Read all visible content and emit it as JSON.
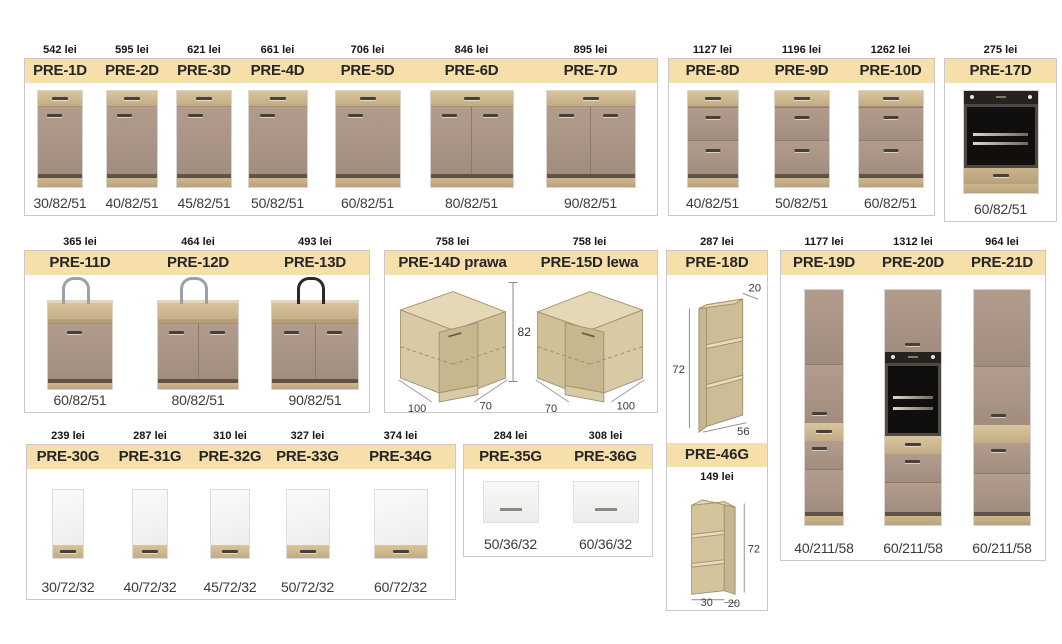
{
  "catalog": {
    "colors": {
      "header_band": "#f6dfaa",
      "box_border": "#c9c9c9",
      "cabinet_door": "#a89384",
      "wood": "#cdb690",
      "dark_strip": "#5f5347",
      "white_door": "#f5f5f3",
      "oven_black": "#141414",
      "page_bg": "#ffffff"
    },
    "groups": [
      {
        "key": "A",
        "name": "base-cabinets-1-7",
        "items": [
          {
            "code": "PRE-1D",
            "price": "542 lei",
            "dims": "30/82/51",
            "art": "base1"
          },
          {
            "code": "PRE-2D",
            "price": "595 lei",
            "dims": "40/82/51",
            "art": "base1"
          },
          {
            "code": "PRE-3D",
            "price": "621 lei",
            "dims": "45/82/51",
            "art": "base1"
          },
          {
            "code": "PRE-4D",
            "price": "661 lei",
            "dims": "50/82/51",
            "art": "base1"
          },
          {
            "code": "PRE-5D",
            "price": "706 lei",
            "dims": "60/82/51",
            "art": "base1"
          },
          {
            "code": "PRE-6D",
            "price": "846 lei",
            "dims": "80/82/51",
            "art": "base2"
          },
          {
            "code": "PRE-7D",
            "price": "895 lei",
            "dims": "90/82/51",
            "art": "base2"
          }
        ]
      },
      {
        "key": "B",
        "name": "drawer-cabinets-8-10",
        "items": [
          {
            "code": "PRE-8D",
            "price": "1127 lei",
            "dims": "40/82/51",
            "art": "drawers"
          },
          {
            "code": "PRE-9D",
            "price": "1196 lei",
            "dims": "50/82/51",
            "art": "drawers"
          },
          {
            "code": "PRE-10D",
            "price": "1262 lei",
            "dims": "60/82/51",
            "art": "drawers"
          }
        ]
      },
      {
        "key": "Q",
        "name": "oven-base-cabinet-17",
        "items": [
          {
            "code": "PRE-17D",
            "price": "275 lei",
            "dims": "60/82/51",
            "art": "ovenbase"
          }
        ]
      },
      {
        "key": "C",
        "name": "sink-cabinets-11-13",
        "items": [
          {
            "code": "PRE-11D",
            "price": "365 lei",
            "dims": "60/82/51",
            "art": "sink1"
          },
          {
            "code": "PRE-12D",
            "price": "464 lei",
            "dims": "80/82/51",
            "art": "sink2"
          },
          {
            "code": "PRE-13D",
            "price": "493 lei",
            "dims": "90/82/51",
            "art": "sink2b"
          }
        ]
      },
      {
        "key": "D",
        "name": "corner-cabinets-14-15",
        "height_label": "82",
        "items": [
          {
            "code": "PRE-14D prawa",
            "price": "758 lei",
            "art": "cornerR",
            "labels": {
              "left": "100",
              "right": "70"
            }
          },
          {
            "code": "PRE-15D lewa",
            "price": "758 lei",
            "art": "cornerL",
            "labels": {
              "left": "70",
              "right": "100"
            }
          }
        ]
      },
      {
        "key": "F",
        "name": "tall-cabinets-19-21",
        "items": [
          {
            "code": "PRE-19D",
            "price": "1177 lei",
            "dims": "40/211/58",
            "art": "tall19"
          },
          {
            "code": "PRE-20D",
            "price": "1312 lei",
            "dims": "60/211/58",
            "art": "tall20"
          },
          {
            "code": "PRE-21D",
            "price": "964 lei",
            "dims": "60/211/58",
            "art": "tall21"
          }
        ]
      },
      {
        "key": "G",
        "name": "wall-cabinets-30-34",
        "items": [
          {
            "code": "PRE-30G",
            "price": "239 lei",
            "dims": "30/72/32",
            "art": "wall"
          },
          {
            "code": "PRE-31G",
            "price": "287 lei",
            "dims": "40/72/32",
            "art": "wall"
          },
          {
            "code": "PRE-32G",
            "price": "310 lei",
            "dims": "45/72/32",
            "art": "wall"
          },
          {
            "code": "PRE-33G",
            "price": "327 lei",
            "dims": "50/72/32",
            "art": "wall"
          },
          {
            "code": "PRE-34G",
            "price": "374 lei",
            "dims": "60/72/32",
            "art": "wall"
          }
        ]
      },
      {
        "key": "H",
        "name": "horizontal-wall-cabinets-35-36",
        "items": [
          {
            "code": "PRE-35G",
            "price": "284 lei",
            "dims": "50/36/32",
            "art": "wallh"
          },
          {
            "code": "PRE-36G",
            "price": "308 lei",
            "dims": "60/36/32",
            "art": "wallh"
          }
        ]
      },
      {
        "key": "E",
        "name": "open-shelf-units-18-46",
        "items": [
          {
            "code": "PRE-18D",
            "price": "287 lei",
            "art": "shelf18",
            "labels": {
              "top": "20",
              "side": "72",
              "bottom": "56"
            }
          },
          {
            "code": "PRE-46G",
            "price": "149 lei",
            "art": "shelf46",
            "labels": {
              "side": "72",
              "bottom_left": "30",
              "bottom_right": "20"
            }
          }
        ]
      }
    ]
  }
}
